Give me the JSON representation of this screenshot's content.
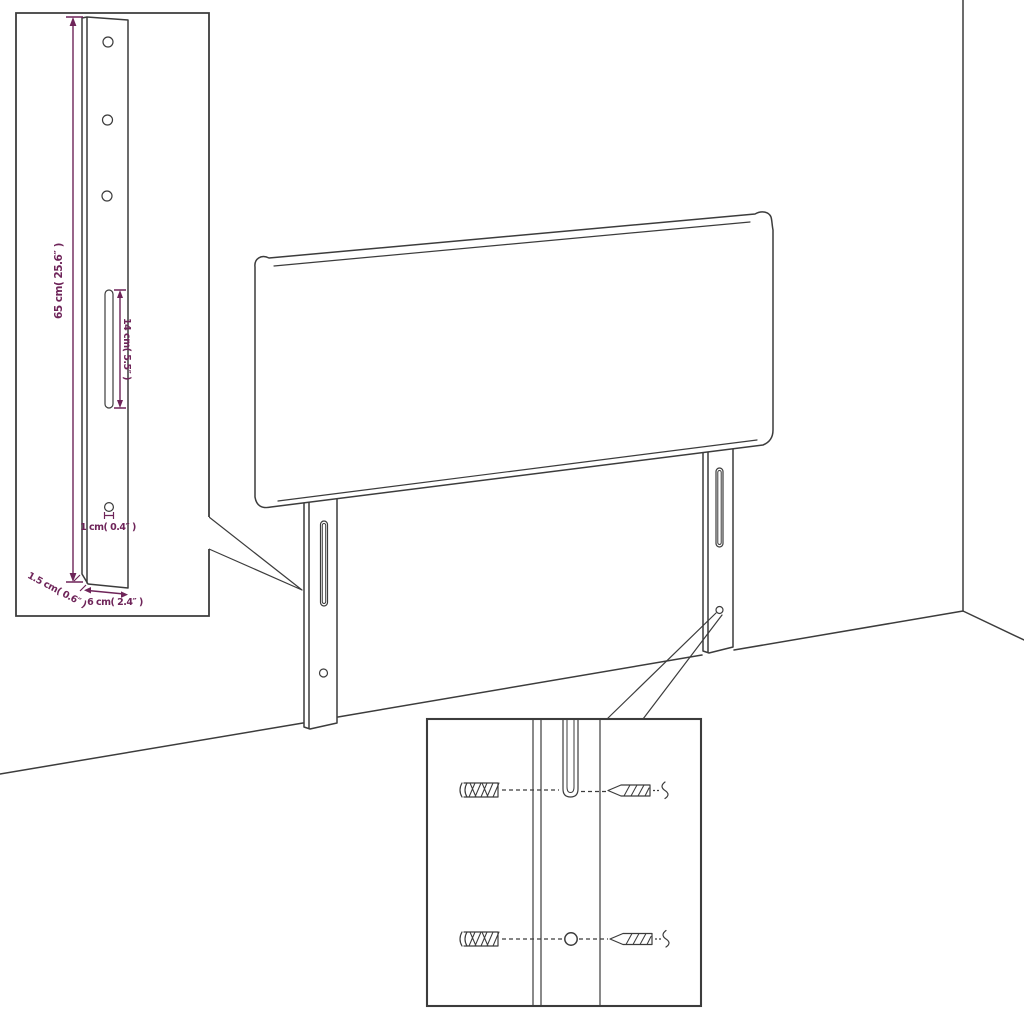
{
  "diagram": {
    "type": "furniture-dimension-diagram",
    "subject": "upholstered headboard with two mounting legs, shown against a room corner, with enlarged leg detail inset and mounting-hardware detail inset",
    "labels": {
      "leg_height": "65 cm( 25.6″ )",
      "slot_length": "14 cm( 5.5″ )",
      "hole_diameter": "1 cm( 0.4″ )",
      "leg_thickness": "1.5 cm( 0.6″ )",
      "leg_width": "6 cm( 2.4″ )"
    },
    "icons": {
      "wall_plug": "hatched-cylinder-anchor",
      "screw": "pointed-threaded-screw",
      "slot": "rounded-vertical-slot",
      "hole": "small-circle"
    },
    "colors": {
      "dimension": "#6e2459",
      "linework": "#3c3c3c",
      "background": "#ffffff"
    }
  }
}
